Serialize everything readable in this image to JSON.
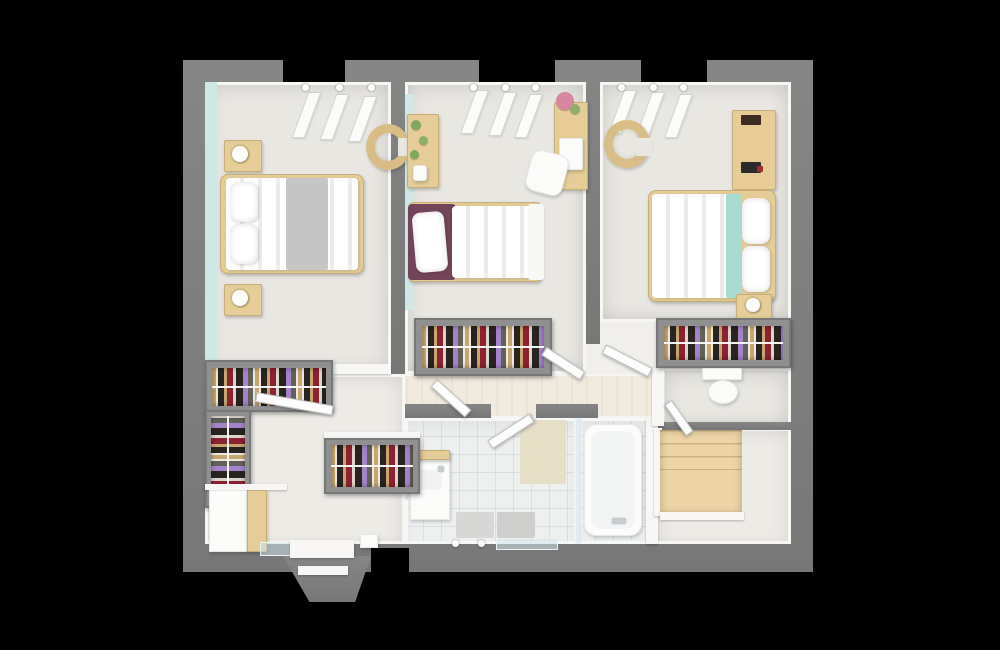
{
  "scene": {
    "kind": "3d-floor-plan-top-view",
    "background": "#000000",
    "palette": {
      "bg": "#000000",
      "wall": "#868686",
      "wallDark": "#777777",
      "floor": "#e9e7e2",
      "floor2": "#edebe6",
      "hall": "#f1eade",
      "tile": "#eef0f0",
      "teal": "#cfe8e5",
      "wood": "#e6cc96",
      "wood2": "#d9bd86",
      "white": "#fbfbfa",
      "maroon": "#73445a",
      "tealFab": "#a7dcd1",
      "c1": "#c7a76f",
      "c2": "#29241f",
      "c3": "#8e2130",
      "c4": "#ddd6cc",
      "c5": "#a583cb",
      "c6": "#63605a",
      "st1": "#ecd5a6",
      "st2": "#c9a86e",
      "st3": "#f1e0b6"
    },
    "objects": [
      {
        "name": "outer-wall",
        "cls": "wall",
        "x": 183,
        "y": 60,
        "w": 630,
        "h": 512
      },
      {
        "name": "window-gap-top-1",
        "cls": "gap",
        "x": 283,
        "y": 60,
        "w": 62,
        "h": 22
      },
      {
        "name": "window-gap-top-2",
        "cls": "gap",
        "x": 479,
        "y": 60,
        "w": 76,
        "h": 22
      },
      {
        "name": "window-gap-top-3",
        "cls": "gap",
        "x": 641,
        "y": 60,
        "w": 66,
        "h": 22
      },
      {
        "name": "floor-base",
        "cls": "floor",
        "x": 205,
        "y": 82,
        "w": 586,
        "h": 462
      },
      {
        "name": "bedroom-left-floor",
        "cls": "room",
        "x": 205,
        "y": 82,
        "w": 186,
        "h": 292
      },
      {
        "name": "bedroom-left-accent-wall",
        "cls": "teal",
        "x": 205,
        "y": 82,
        "w": 12,
        "h": 292
      },
      {
        "name": "bedroom-middle-floor",
        "cls": "room",
        "x": 405,
        "y": 82,
        "w": 181,
        "h": 292
      },
      {
        "name": "bedroom-middle-accent-wall",
        "cls": "teal",
        "x": 405,
        "y": 94,
        "w": 8,
        "h": 216
      },
      {
        "name": "bedroom-right-floor",
        "cls": "room",
        "x": 600,
        "y": 82,
        "w": 191,
        "h": 240
      },
      {
        "name": "hallway-floor",
        "cls": "hall",
        "x": 391,
        "y": 374,
        "w": 271,
        "h": 44
      },
      {
        "name": "dressing-floor",
        "cls": "room2",
        "x": 205,
        "y": 374,
        "w": 200,
        "h": 170
      },
      {
        "name": "bathroom-floor",
        "cls": "tiles",
        "x": 405,
        "y": 418,
        "w": 172,
        "h": 126
      },
      {
        "name": "shower-floor",
        "cls": "tiles",
        "x": 577,
        "y": 418,
        "w": 73,
        "h": 126
      },
      {
        "name": "wc-floor",
        "cls": "room",
        "x": 662,
        "y": 368,
        "w": 129,
        "h": 60
      },
      {
        "name": "landing-floor",
        "cls": "room2",
        "x": 655,
        "y": 428,
        "w": 136,
        "h": 116
      },
      {
        "name": "wall-bedroom1-bedroom2",
        "cls": "wall",
        "x": 391,
        "y": 60,
        "w": 14,
        "h": 314
      },
      {
        "name": "wall-bedroom2-bedroom3",
        "cls": "wall",
        "x": 586,
        "y": 60,
        "w": 14,
        "h": 284
      },
      {
        "name": "wall-bathroom-top-left",
        "cls": "wall",
        "x": 405,
        "y": 404,
        "w": 86,
        "h": 14
      },
      {
        "name": "wall-bathroom-top-right",
        "cls": "wall",
        "x": 536,
        "y": 404,
        "w": 62,
        "h": 14
      },
      {
        "name": "wall-wc-bottom",
        "cls": "wall",
        "x": 650,
        "y": 422,
        "w": 141,
        "h": 8
      },
      {
        "name": "wall-bathroom-right-white",
        "cls": "wwall",
        "x": 646,
        "y": 418,
        "w": 12,
        "h": 126
      },
      {
        "name": "wall-wc-left-white",
        "cls": "wwall",
        "x": 652,
        "y": 368,
        "w": 12,
        "h": 58
      },
      {
        "name": "stair-balustrade-left",
        "cls": "wwall",
        "x": 654,
        "y": 428,
        "w": 8,
        "h": 88
      },
      {
        "name": "staircase-winder",
        "cls": "stairs",
        "x": 660,
        "y": 430,
        "w": 82,
        "h": 84
      },
      {
        "name": "stair-balustrade-bottom",
        "cls": "wwall",
        "x": 660,
        "y": 512,
        "w": 84,
        "h": 8
      },
      {
        "name": "half-wall-bedroom1-bottom",
        "cls": "wwall",
        "x": 333,
        "y": 364,
        "w": 58,
        "h": 10
      },
      {
        "name": "roof-window-slat",
        "cls": "slat",
        "x": 300,
        "y": 92,
        "w": 13,
        "h": 46
      },
      {
        "name": "roof-window-slat",
        "cls": "slat",
        "x": 328,
        "y": 94,
        "w": 13,
        "h": 46
      },
      {
        "name": "roof-window-slat",
        "cls": "slat",
        "x": 356,
        "y": 96,
        "w": 13,
        "h": 46
      },
      {
        "name": "roof-window-slat",
        "cls": "slat",
        "x": 468,
        "y": 90,
        "w": 13,
        "h": 44
      },
      {
        "name": "roof-window-slat",
        "cls": "slat",
        "x": 496,
        "y": 92,
        "w": 13,
        "h": 44
      },
      {
        "name": "roof-window-slat",
        "cls": "slat",
        "x": 522,
        "y": 94,
        "w": 13,
        "h": 44
      },
      {
        "name": "roof-window-slat",
        "cls": "slat",
        "x": 616,
        "y": 90,
        "w": 13,
        "h": 44
      },
      {
        "name": "roof-window-slat",
        "cls": "slat",
        "x": 644,
        "y": 92,
        "w": 13,
        "h": 44
      },
      {
        "name": "roof-window-slat",
        "cls": "slat",
        "x": 672,
        "y": 94,
        "w": 13,
        "h": 44
      },
      {
        "name": "marker-dot",
        "cls": "dot",
        "x": 302,
        "y": 84,
        "w": 7,
        "h": 7
      },
      {
        "name": "marker-dot",
        "cls": "dot",
        "x": 336,
        "y": 84,
        "w": 7,
        "h": 7
      },
      {
        "name": "marker-dot",
        "cls": "dot",
        "x": 368,
        "y": 84,
        "w": 7,
        "h": 7
      },
      {
        "name": "marker-dot",
        "cls": "dot",
        "x": 470,
        "y": 84,
        "w": 7,
        "h": 7
      },
      {
        "name": "marker-dot",
        "cls": "dot",
        "x": 502,
        "y": 84,
        "w": 7,
        "h": 7
      },
      {
        "name": "marker-dot",
        "cls": "dot",
        "x": 532,
        "y": 84,
        "w": 7,
        "h": 7
      },
      {
        "name": "marker-dot",
        "cls": "dot",
        "x": 618,
        "y": 84,
        "w": 7,
        "h": 7
      },
      {
        "name": "marker-dot",
        "cls": "dot",
        "x": 650,
        "y": 84,
        "w": 7,
        "h": 7
      },
      {
        "name": "marker-dot",
        "cls": "dot",
        "x": 680,
        "y": 84,
        "w": 7,
        "h": 7
      },
      {
        "name": "marker-dot",
        "cls": "dot",
        "x": 452,
        "y": 540,
        "w": 7,
        "h": 7
      },
      {
        "name": "marker-dot",
        "cls": "dot",
        "x": 478,
        "y": 540,
        "w": 7,
        "h": 7
      },
      {
        "name": "nightstand",
        "cls": "wood",
        "x": 224,
        "y": 140,
        "w": 38,
        "h": 32
      },
      {
        "name": "lamp",
        "cls": "lamp",
        "x": 232,
        "y": 146,
        "w": 16,
        "h": 16
      },
      {
        "name": "nightstand",
        "cls": "wood",
        "x": 224,
        "y": 284,
        "w": 38,
        "h": 32
      },
      {
        "name": "lamp",
        "cls": "lamp",
        "x": 232,
        "y": 290,
        "w": 16,
        "h": 16
      },
      {
        "name": "double-bed-frame",
        "cls": "wood",
        "x": 220,
        "y": 174,
        "w": 144,
        "h": 100,
        "r": 8
      },
      {
        "name": "double-bed-duvet",
        "cls": "duvet-v",
        "x": 226,
        "y": 178,
        "w": 132,
        "h": 92
      },
      {
        "name": "bed-gray-blanket",
        "x": 286,
        "y": 178,
        "w": 42,
        "h": 92,
        "bg": "#c6c6c6",
        "r": 2
      },
      {
        "name": "bed-pillow",
        "cls": "pillow",
        "x": 230,
        "y": 182,
        "w": 28,
        "h": 40
      },
      {
        "name": "bed-pillow",
        "cls": "pillow",
        "x": 230,
        "y": 224,
        "w": 28,
        "h": 40
      },
      {
        "name": "armchair-curved",
        "cls": "ring",
        "x": 366,
        "y": 124,
        "w": 44,
        "h": 46
      },
      {
        "name": "armchair-opening",
        "x": 398,
        "y": 138,
        "w": 14,
        "h": 18,
        "bg": "#e9e7e2"
      },
      {
        "name": "plant-shelf",
        "cls": "wood",
        "x": 407,
        "y": 114,
        "w": 32,
        "h": 74
      },
      {
        "name": "plant",
        "cls": "plant",
        "x": 411,
        "y": 120,
        "w": 10,
        "h": 10,
        "bg": "#7fa75f"
      },
      {
        "name": "plant",
        "cls": "plant",
        "x": 419,
        "y": 136,
        "w": 9,
        "h": 9,
        "bg": "#8fae6a"
      },
      {
        "name": "plant",
        "cls": "plant",
        "x": 410,
        "y": 150,
        "w": 9,
        "h": 9,
        "bg": "#7fa75f"
      },
      {
        "name": "vase",
        "cls": "white",
        "x": 413,
        "y": 165,
        "w": 14,
        "h": 16,
        "r": 3
      },
      {
        "name": "desk",
        "cls": "wood",
        "x": 554,
        "y": 102,
        "w": 34,
        "h": 88
      },
      {
        "name": "flower-bouquet",
        "cls": "plant",
        "x": 556,
        "y": 92,
        "w": 18,
        "h": 18,
        "bg": "#d886a0"
      },
      {
        "name": "flower-leaves",
        "cls": "plant",
        "x": 570,
        "y": 104,
        "w": 10,
        "h": 10,
        "bg": "#8fae6a"
      },
      {
        "name": "paper-sheet",
        "cls": "white",
        "x": 559,
        "y": 138,
        "w": 24,
        "h": 32,
        "r": 2
      },
      {
        "name": "desk-chair",
        "cls": "white",
        "x": 528,
        "y": 152,
        "w": 38,
        "h": 42,
        "r": 10,
        "rot": 15
      },
      {
        "name": "single-bed-frame",
        "cls": "wood",
        "x": 408,
        "y": 202,
        "w": 134,
        "h": 80,
        "r": 6
      },
      {
        "name": "single-bed-headboard",
        "x": 408,
        "y": 204,
        "w": 48,
        "h": 76,
        "bg": "#73445a",
        "r": 4
      },
      {
        "name": "bed-pillow",
        "cls": "pillow",
        "x": 414,
        "y": 212,
        "w": 32,
        "h": 60,
        "rot": -5
      },
      {
        "name": "single-bed-duvet",
        "cls": "duvet-v",
        "x": 452,
        "y": 206,
        "w": 80,
        "h": 72
      },
      {
        "name": "bed-throw",
        "x": 528,
        "y": 204,
        "w": 16,
        "h": 76,
        "bg": "#f7f7f6",
        "r": 3
      },
      {
        "name": "closet-frame",
        "cls": "closetframe",
        "x": 414,
        "y": 318,
        "w": 138,
        "h": 58
      },
      {
        "name": "closet-clothes-rail",
        "cls": "clothes",
        "x": 422,
        "y": 326,
        "w": 122,
        "h": 42
      },
      {
        "name": "armchair-curved",
        "cls": "ring",
        "x": 604,
        "y": 120,
        "w": 46,
        "h": 48
      },
      {
        "name": "armchair-opening",
        "x": 636,
        "y": 138,
        "w": 16,
        "h": 18,
        "bg": "#e9e7e2"
      },
      {
        "name": "dresser",
        "cls": "wood",
        "x": 732,
        "y": 110,
        "w": 44,
        "h": 80
      },
      {
        "name": "dresser-item",
        "x": 741,
        "y": 115,
        "w": 20,
        "h": 10,
        "bg": "#3a2d22",
        "r": 1
      },
      {
        "name": "dresser-item",
        "x": 741,
        "y": 162,
        "w": 20,
        "h": 11,
        "bg": "#2b2b2e",
        "r": 1
      },
      {
        "name": "dresser-item-red",
        "x": 757,
        "y": 166,
        "w": 6,
        "h": 6,
        "bg": "#a03030",
        "r": 1
      },
      {
        "name": "double-bed-frame",
        "cls": "wood",
        "x": 648,
        "y": 190,
        "w": 128,
        "h": 112,
        "r": 8
      },
      {
        "name": "double-bed-duvet",
        "cls": "duvet-v",
        "x": 652,
        "y": 194,
        "w": 88,
        "h": 104
      },
      {
        "name": "bed-teal-blanket",
        "x": 726,
        "y": 194,
        "w": 16,
        "h": 104,
        "bg": "#a7dcd1",
        "r": 2
      },
      {
        "name": "bed-pillow",
        "cls": "pillow",
        "x": 742,
        "y": 198,
        "w": 28,
        "h": 46
      },
      {
        "name": "bed-pillow",
        "cls": "pillow",
        "x": 742,
        "y": 246,
        "w": 28,
        "h": 46
      },
      {
        "name": "nightstand",
        "cls": "wood",
        "x": 736,
        "y": 294,
        "w": 36,
        "h": 28
      },
      {
        "name": "lamp",
        "cls": "lamp",
        "x": 746,
        "y": 298,
        "w": 14,
        "h": 14
      },
      {
        "name": "closet-frame",
        "cls": "closetframe",
        "x": 656,
        "y": 318,
        "w": 135,
        "h": 50
      },
      {
        "name": "closet-clothes-rail",
        "cls": "clothes",
        "x": 664,
        "y": 326,
        "w": 119,
        "h": 34
      },
      {
        "name": "toilet-tank",
        "cls": "white",
        "x": 702,
        "y": 368,
        "w": 40,
        "h": 12,
        "r": 2
      },
      {
        "name": "toilet-bowl",
        "cls": "white",
        "x": 708,
        "y": 380,
        "w": 30,
        "h": 24,
        "r": "50%"
      },
      {
        "name": "bathroom-tile-panel",
        "x": 520,
        "y": 420,
        "w": 46,
        "h": 64,
        "bg": "#e7dec6"
      },
      {
        "name": "sink-cabinet",
        "cls": "white",
        "x": 410,
        "y": 450,
        "w": 40,
        "h": 70
      },
      {
        "name": "sink-cabinet-top",
        "cls": "wood",
        "x": 410,
        "y": 450,
        "w": 40,
        "h": 10
      },
      {
        "name": "sink-basin",
        "x": 416,
        "y": 470,
        "w": 26,
        "h": 20,
        "bg": "#f1f3f3",
        "r": 4
      },
      {
        "name": "faucet",
        "cls": "silver",
        "x": 438,
        "y": 466,
        "w": 6,
        "h": 6
      },
      {
        "name": "mirror",
        "x": 405,
        "y": 454,
        "w": 6,
        "h": 46,
        "bg": "#dde4e6"
      },
      {
        "name": "bath-mat",
        "x": 456,
        "y": 512,
        "w": 38,
        "h": 26,
        "bg": "#d7d7d5",
        "r": 2
      },
      {
        "name": "bath-mat",
        "x": 497,
        "y": 512,
        "w": 38,
        "h": 26,
        "bg": "#cfcfcd",
        "r": 2
      },
      {
        "name": "shower-glass-wall",
        "cls": "glass",
        "x": 575,
        "y": 418,
        "w": 7,
        "h": 126
      },
      {
        "name": "bathtub",
        "cls": "white",
        "x": 584,
        "y": 424,
        "w": 58,
        "h": 112,
        "r": 12
      },
      {
        "name": "bathtub-inner",
        "x": 591,
        "y": 431,
        "w": 44,
        "h": 98,
        "bg": "#f3f5f5",
        "r": 10
      },
      {
        "name": "tub-faucet",
        "cls": "silver",
        "x": 612,
        "y": 518,
        "w": 14,
        "h": 6
      },
      {
        "name": "bathroom-window",
        "cls": "glass",
        "x": 496,
        "y": 538,
        "w": 62,
        "h": 12
      },
      {
        "name": "wardrobe-frame",
        "cls": "closetframe",
        "x": 205,
        "y": 360,
        "w": 128,
        "h": 52
      },
      {
        "name": "wardrobe-clothes-rail",
        "cls": "clothes",
        "x": 212,
        "y": 368,
        "w": 114,
        "h": 38
      },
      {
        "name": "wardrobe-frame",
        "cls": "closetframe",
        "x": 205,
        "y": 410,
        "w": 46,
        "h": 98
      },
      {
        "name": "wardrobe-clothes-rail",
        "cls": "clothes-v",
        "x": 211,
        "y": 416,
        "w": 34,
        "h": 86
      },
      {
        "name": "shelf-board",
        "cls": "door",
        "x": 256,
        "y": 392,
        "w": 78,
        "h": 10,
        "rot": 10
      },
      {
        "name": "wardrobe-top-shelf",
        "cls": "wwall",
        "x": 324,
        "y": 432,
        "w": 96,
        "h": 9
      },
      {
        "name": "wardrobe-frame",
        "cls": "closetframe",
        "x": 324,
        "y": 438,
        "w": 96,
        "h": 56
      },
      {
        "name": "wardrobe-clothes-rail",
        "cls": "clothes",
        "x": 331,
        "y": 445,
        "w": 82,
        "h": 42
      },
      {
        "name": "closet-room-divider",
        "cls": "wwall",
        "x": 205,
        "y": 484,
        "w": 82,
        "h": 6
      },
      {
        "name": "storage-cabinet",
        "cls": "white",
        "x": 209,
        "y": 490,
        "w": 38,
        "h": 62
      },
      {
        "name": "storage-wood-panel",
        "cls": "wood",
        "x": 247,
        "y": 490,
        "w": 20,
        "h": 62
      },
      {
        "name": "dressing-window",
        "cls": "glass",
        "x": 260,
        "y": 542,
        "w": 40,
        "h": 14
      },
      {
        "name": "dormer-slab",
        "cls": "wall",
        "x": 283,
        "y": 556,
        "w": 88,
        "h": 46,
        "clip": "polygon(0 0,100% 0,82% 100%,30% 100%)"
      },
      {
        "name": "dormer-floor",
        "cls": "wwall",
        "x": 290,
        "y": 540,
        "w": 64,
        "h": 18
      },
      {
        "name": "dormer-window-frame",
        "cls": "wwall",
        "x": 298,
        "y": 566,
        "w": 50,
        "h": 9
      },
      {
        "name": "window-gap-bottom",
        "cls": "gap",
        "x": 371,
        "y": 548,
        "w": 38,
        "h": 24
      },
      {
        "name": "wall-vent",
        "cls": "white",
        "x": 360,
        "y": 534,
        "w": 18,
        "h": 14
      },
      {
        "name": "door-leaf-bedroom-left",
        "cls": "door",
        "x": 434,
        "y": 378,
        "w": 46,
        "h": 10,
        "rot": 42
      },
      {
        "name": "door-leaf-bedroom-middle",
        "cls": "door",
        "x": 544,
        "y": 346,
        "w": 46,
        "h": 10,
        "rot": 33
      },
      {
        "name": "door-leaf-bedroom-right",
        "cls": "door",
        "x": 604,
        "y": 344,
        "w": 52,
        "h": 10,
        "rot": 27
      },
      {
        "name": "door-leaf-bathroom",
        "cls": "door",
        "x": 490,
        "y": 440,
        "w": 50,
        "h": 10,
        "rot": -33
      },
      {
        "name": "door-leaf-wc",
        "cls": "door",
        "x": 668,
        "y": 398,
        "w": 38,
        "h": 9,
        "rot": 55
      }
    ]
  }
}
